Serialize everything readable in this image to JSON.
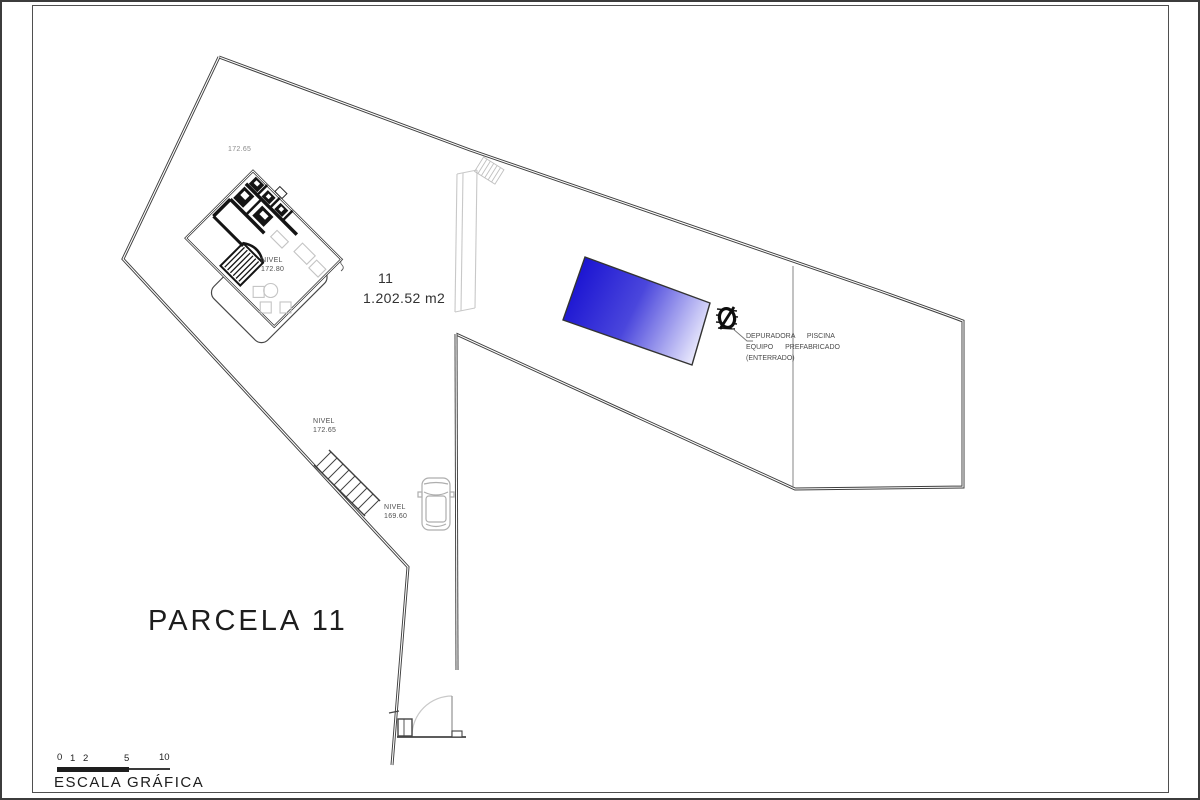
{
  "colors": {
    "pool_dark": "#1c15d2",
    "pool_mid": "#4a46dc",
    "pool_light": "#f2f2fe",
    "line_dark": "#3f3f3f",
    "line_light": "#b9b9b9"
  },
  "labels": {
    "parcel_title": "PARCELA 11",
    "top_elevation": "172.65",
    "parcel_number": "11",
    "parcel_area": "1.202.52 m2",
    "house_level": {
      "line1": "NIVEL",
      "line2": "172.80"
    },
    "mid_level": {
      "line1": "NIVEL",
      "line2": "172.65"
    },
    "garage_level": {
      "line1": "NIVEL",
      "line2": "169.60"
    },
    "pump_note": {
      "line1": "DEPURADORA  PISCINA",
      "line2": "EQUIPO  PREFABRICADO",
      "line3": "(ENTERRADO)"
    }
  },
  "scale_bar": {
    "title": "ESCALA GRÁFICA",
    "ticks": [
      "0",
      "1",
      "2",
      "5",
      "10"
    ]
  }
}
